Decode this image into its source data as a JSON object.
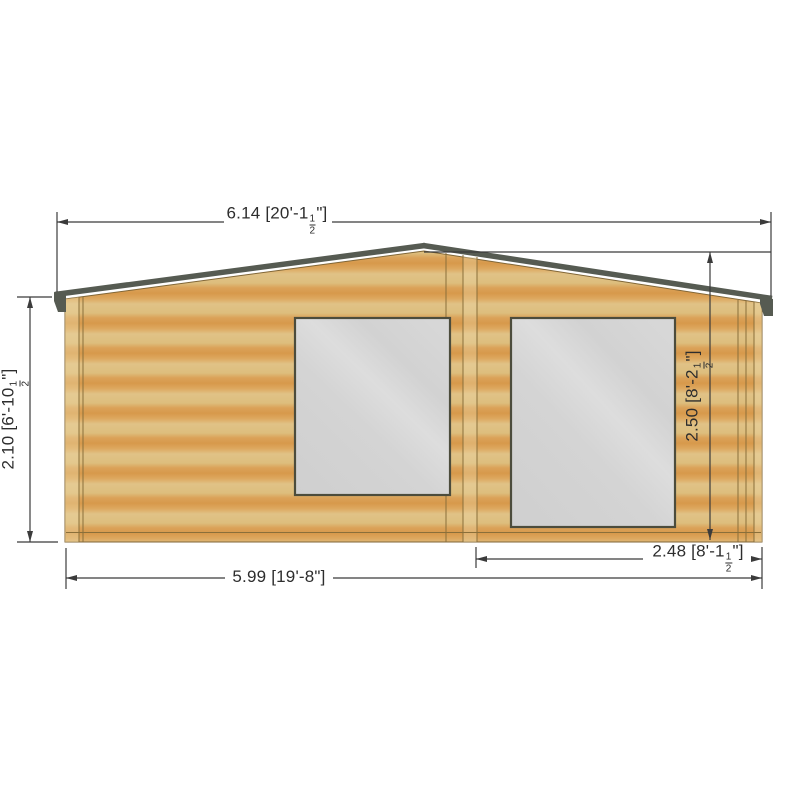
{
  "drawing": {
    "subject": "log-cabin-front-elevation",
    "style": "cad-dimensioned-elevation"
  },
  "palette": {
    "background": "#ffffff",
    "wood_light": "#dfc183",
    "wood_dark": "#db9e51",
    "wood_trim_highlight": "#ecd5a2",
    "wood_line": "#8a6f3a",
    "roof": "#565b52",
    "glass": "#d2d2d2",
    "window_frame": "#4c4c3c",
    "dimension_line": "#3b3b3b",
    "dimension_text": "#2d2d2d"
  },
  "dimensions": {
    "top_width": {
      "metric": "6.14",
      "imperial_prefix": "[20'-1",
      "frac_num": "1",
      "frac_den": "2",
      "imperial_suffix": "\"]"
    },
    "left_height": {
      "metric": "2.10",
      "imperial_prefix": "[6'-10",
      "frac_num": "1",
      "frac_den": "2",
      "imperial_suffix": "\"]"
    },
    "right_height": {
      "metric": "2.50",
      "imperial_prefix": "[8'-2",
      "frac_num": "1",
      "frac_den": "2",
      "imperial_suffix": "\"]"
    },
    "bottom_right_width": {
      "metric": "2.48",
      "imperial_prefix": "[8'-1",
      "frac_num": "1",
      "frac_den": "2",
      "imperial_suffix": "\"]"
    },
    "bottom_width": {
      "metric": "5.99",
      "imperial_prefix": "[19'-8",
      "imperial_suffix": "\"]"
    }
  }
}
